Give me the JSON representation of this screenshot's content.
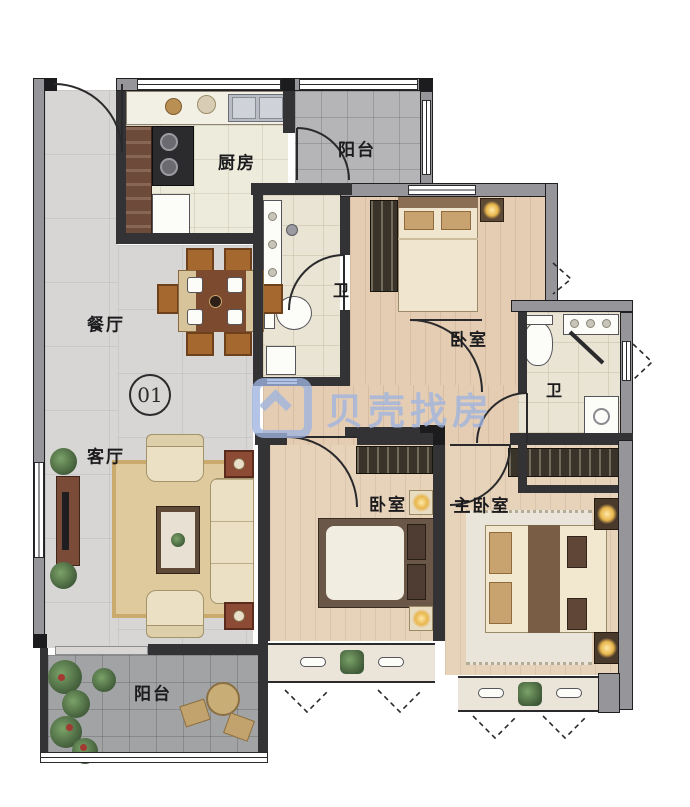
{
  "plan": {
    "unit_badge": "01",
    "rooms": {
      "kitchen": {
        "label": "厨房"
      },
      "balcony_top": {
        "label": "阳台"
      },
      "bath_center": {
        "label": "卫"
      },
      "bath_right": {
        "label": "卫"
      },
      "bedroom_top": {
        "label": "卧室"
      },
      "bedroom_bottom": {
        "label": "卧室"
      },
      "master_bedroom": {
        "label": "主卧室"
      },
      "dining": {
        "label": "餐厅"
      },
      "living": {
        "label": "客厅"
      },
      "balcony_bottom": {
        "label": "阳台"
      }
    }
  },
  "watermark": {
    "brand": "贝壳找房",
    "color": "#9fb4e0"
  },
  "colors": {
    "wall_fill": "#95959a",
    "wall_line": "#202022",
    "wood_floor": "#e4cdb3",
    "marble_floor": "#d8d6d4",
    "bath_floor": "#e9e4d4",
    "balcony_tile": "#a2a3a5"
  }
}
